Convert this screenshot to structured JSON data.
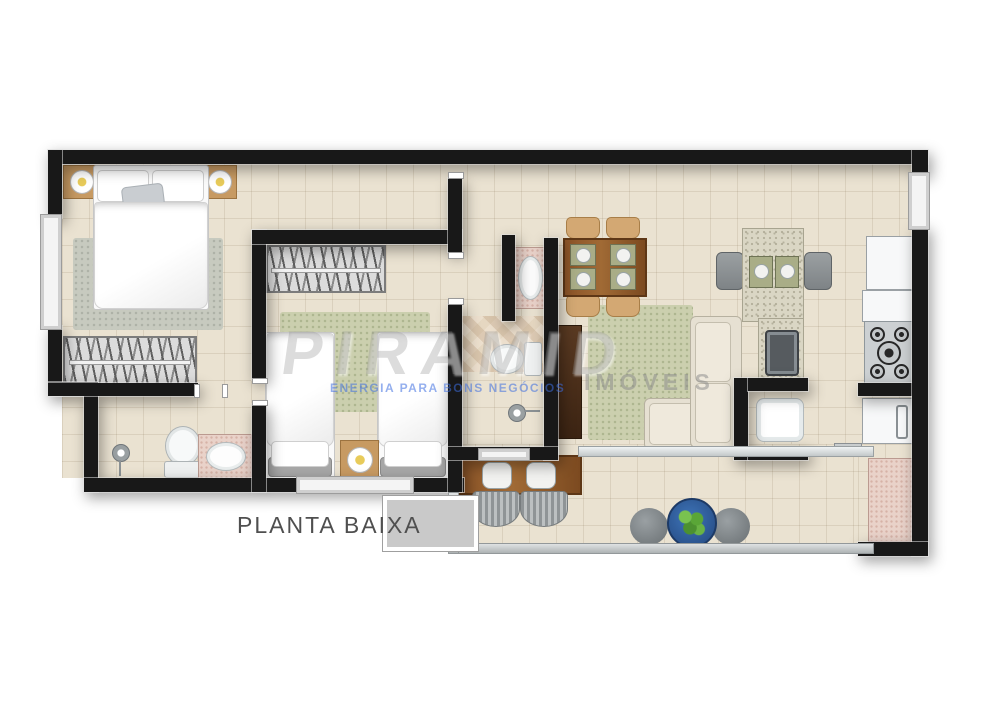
{
  "label": {
    "title": "PLANTA BAIXA"
  },
  "watermark": {
    "brand": "PIRAMID",
    "tagline": "ENERGIA PARA BONS NEGÓCIOS",
    "division": "IMÓVEIS"
  },
  "palette": {
    "wall": "#181818",
    "floor_tile": "#eae2d1",
    "wood": "#8a5327",
    "granite_counter": "#dad6c4",
    "rug_sage": "#cbcfae",
    "rug_gray": "#c7cabf",
    "pink_counter": "#e9d2c9",
    "sofa_beige": "#e6e0d2",
    "chair_tan": "#d3a873",
    "planter_blue": "#2f5f9e",
    "plant_green": "#57a234",
    "watermark_blue": "#3c6ee0",
    "title_gray": "#4f4f4f"
  },
  "plan": {
    "type": "apartment-floor-plan",
    "rooms": [
      {
        "name": "master bedroom",
        "furniture": [
          "double bed",
          "2 nightstands with lamps",
          "rug",
          "wardrobe"
        ]
      },
      {
        "name": "bathroom 1",
        "furniture": [
          "shower",
          "toilet",
          "sink counter"
        ]
      },
      {
        "name": "bedroom 2",
        "furniture": [
          "2 single beds",
          "nightstand with lamp",
          "wardrobe",
          "rug"
        ]
      },
      {
        "name": "bathroom 2",
        "furniture": [
          "sink counter",
          "toilet",
          "shower"
        ]
      },
      {
        "name": "living dining room",
        "furniture": [
          "dining table with 4 chairs",
          "L-shaped sofa",
          "rug",
          "sideboard"
        ]
      },
      {
        "name": "kitchen",
        "furniture": [
          "breakfast counter with 2 stools",
          "sink",
          "cooktop",
          "refrigerator"
        ]
      },
      {
        "name": "laundry",
        "furniture": [
          "washing machine",
          "counter",
          "washbasin"
        ]
      },
      {
        "name": "balcony",
        "furniture": [
          "table with 2 chairs",
          "planter",
          "2 poufs"
        ]
      }
    ]
  }
}
